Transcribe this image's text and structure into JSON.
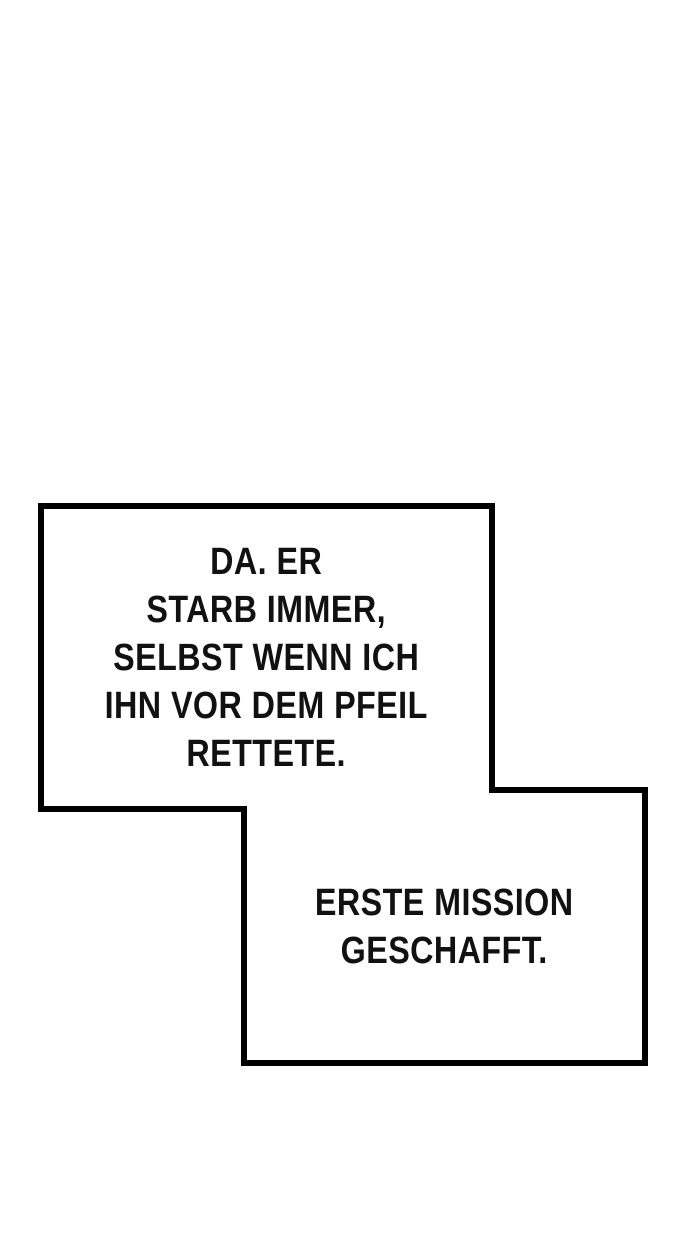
{
  "panel": {
    "type": "comic-speech-panel",
    "colors": {
      "background": "#ffffff",
      "outline": "#000000",
      "text": "#111111"
    },
    "bubbles": [
      {
        "id": "bubble-1",
        "text": "DA. ER\nSTARB IMMER,\nSELBST WENN ICH\nIHN VOR DEM PFEIL\nRETTETE."
      },
      {
        "id": "bubble-2",
        "text": "ERSTE MISSION\nGESCHAFFT."
      }
    ]
  }
}
